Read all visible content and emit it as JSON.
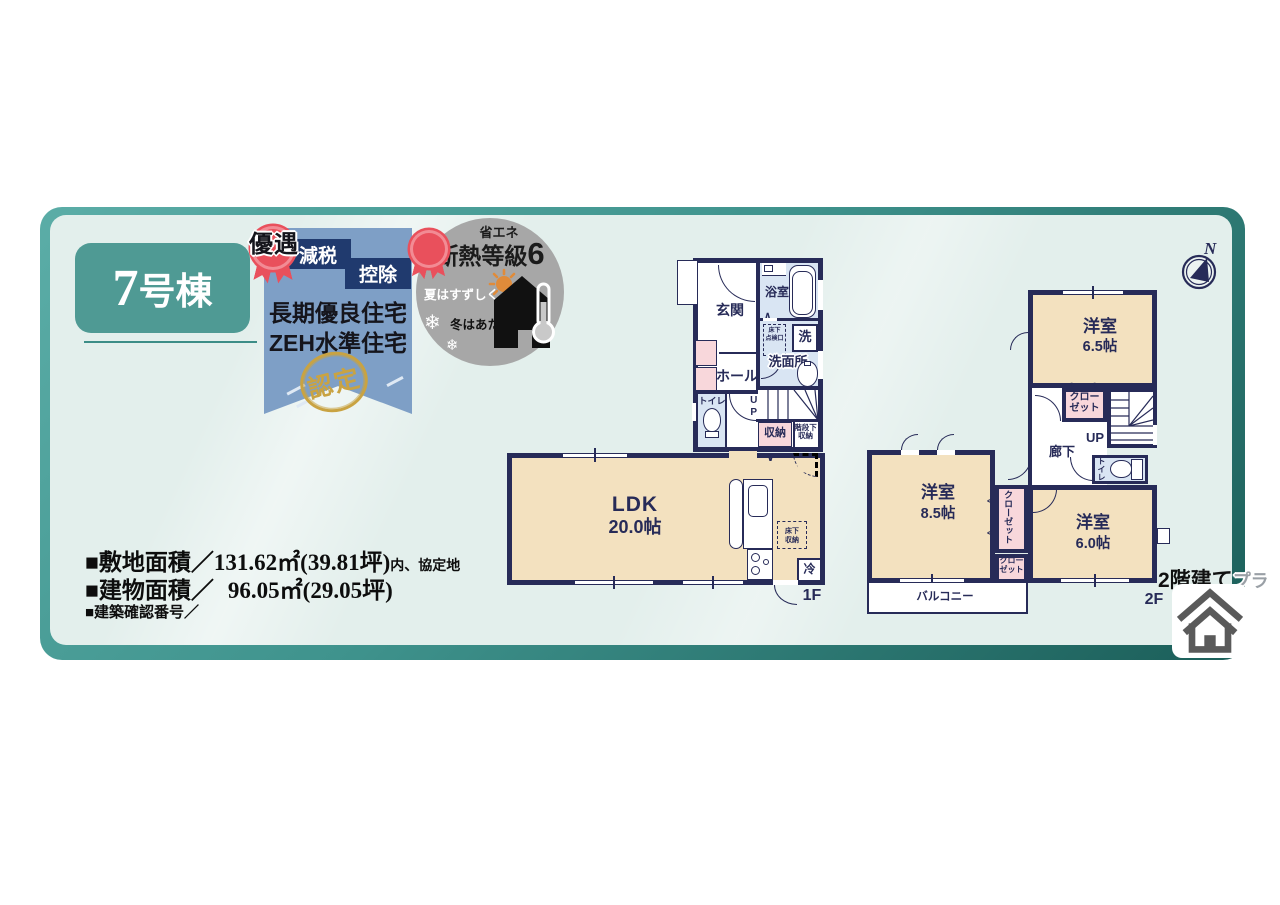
{
  "unit": {
    "number": "7",
    "suffix": "号棟"
  },
  "banner": {
    "rosette": "優遇",
    "badge1": "減税",
    "badge2": "控除",
    "line1": "長期優良住宅",
    "line2": "ZEH水準住宅",
    "stamp": "認定"
  },
  "insulation": {
    "category": "省エネ",
    "title": "断熱等級",
    "grade": "6",
    "summer": "夏はすずしく",
    "winter": "冬はあたたかい"
  },
  "icons": {
    "snowflake": "❄",
    "north": "N",
    "chevron_up": "∧",
    "chevron_down": "∨",
    "chevron_left": "<",
    "chevron_right": ">"
  },
  "areas": {
    "site_label": "■敷地面積／",
    "site_value": "131.62㎡(39.81坪)",
    "site_note": "内、協定地",
    "building_label": "■建物面積／",
    "building_value": "96.05㎡(29.05坪)",
    "confirm_label": "■建築確認番号／"
  },
  "plan_type": {
    "label": "2階建て",
    "suffix": "プラ"
  },
  "floor1": {
    "label": "1F",
    "genkan": "玄関",
    "bath": "浴室",
    "laundry": "洗",
    "washroom": "洗面所",
    "hall": "ホール",
    "toilet": "トイレ",
    "up": "UP",
    "storage": "収納",
    "under_stairs": "階段下\n収納",
    "ldk": "LDK",
    "ldk_size": "20.0帖",
    "floor_storage": "床下\n収納",
    "inspection": "床下\n点検口",
    "fridge": "冷"
  },
  "floor2": {
    "label": "2F",
    "room1": "洋室",
    "room1_size": "6.5帖",
    "room2": "洋室",
    "room2_size": "8.5帖",
    "room3": "洋室",
    "room3_size": "6.0帖",
    "closet": "クロー\nゼット",
    "closet_v": "クローゼット",
    "hallway": "廊下",
    "up": "UP",
    "toilet": "トイレ",
    "balcony": "バルコニー"
  },
  "colors": {
    "wall_navy": "#272b58",
    "room_cream": "#f3e1bf",
    "wet_blue": "#d9e5f3",
    "closet_pink": "#f8d7db",
    "card_teal": "#4f9a94",
    "banner_blue": "#7e9fc6",
    "badge_navy": "#203a6e",
    "rosette_red": "#e9505c",
    "stamp_gold": "#c9a342",
    "circle_gray": "#a7a7a7"
  }
}
